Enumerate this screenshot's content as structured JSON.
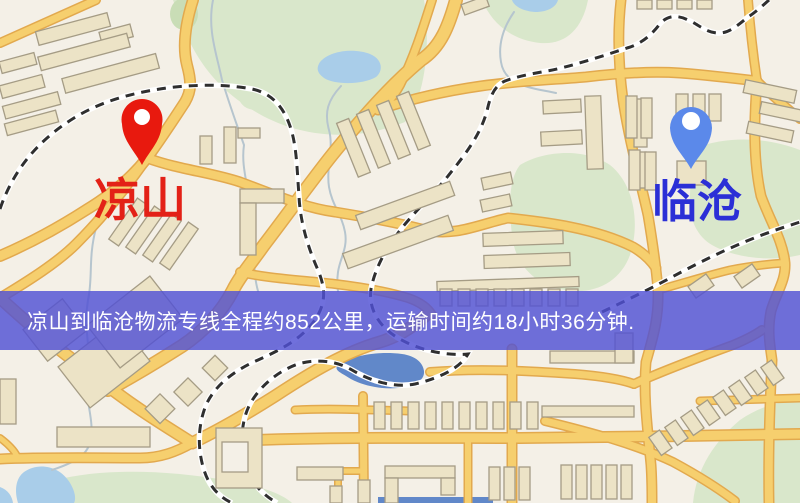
{
  "banner": {
    "text": "凉山到临沧物流专线全程约852公里，运输时间约18小时36分钟.",
    "bg_color": "#5151d4",
    "text_color": "#ffffff"
  },
  "markers": {
    "origin": {
      "label": "凉山",
      "pin_color": "#e8190e",
      "label_color": "#e32117"
    },
    "destination": {
      "label": "临沧",
      "pin_color": "#5b89ea",
      "label_color": "#2b2fd6"
    }
  },
  "map_palette": {
    "background": "#f4f0e7",
    "road_fill": "#f6cf6e",
    "road_casing": "#e2a94e",
    "railway": "#2f2f2f",
    "green": "#d9e7cb",
    "green_dark": "#c9ddb6",
    "water_light": "#a9cde9",
    "water_dark": "#6188c9",
    "stream": "#b6c5ce",
    "building_fill": "#ece3c6",
    "building_stroke": "#a59c85"
  }
}
